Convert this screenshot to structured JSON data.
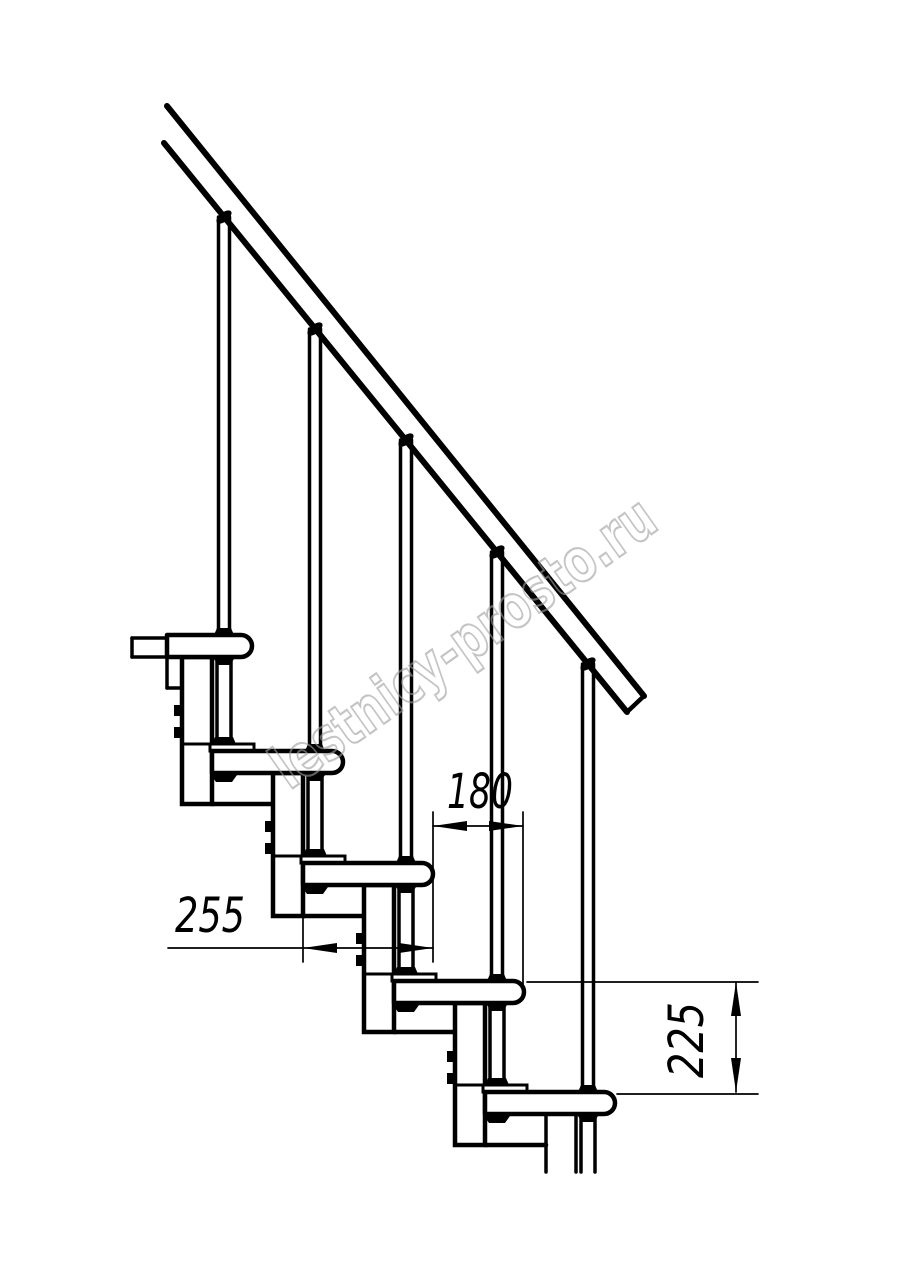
{
  "meta": {
    "title": "Modular staircase side-view technical drawing",
    "watermark_text": "lestnicy-prosto.ru"
  },
  "dimensions_mm": {
    "tread_depth_label": "255",
    "step_run_label": "180",
    "step_rise_label": "225"
  },
  "drawing": {
    "canvas": {
      "w": 914,
      "h": 1280,
      "bg": "#ffffff",
      "ink": "#000000"
    },
    "rail": {
      "top_line": [
        167,
        106,
        644,
        696
      ],
      "bottom_line": [
        164,
        143,
        627,
        712
      ],
      "end_cap": [
        644,
        696,
        627,
        712
      ],
      "stroke": 6
    },
    "tread": {
      "h": 22,
      "r": 11,
      "stroke": 4.5
    },
    "treads": [
      {
        "x": 167,
        "y": 635,
        "len": 85
      },
      {
        "x": 212,
        "y": 751,
        "len": 131
      },
      {
        "x": 303,
        "y": 863,
        "len": 130
      },
      {
        "x": 394,
        "y": 981,
        "len": 130
      },
      {
        "x": 485,
        "y": 1092,
        "len": 130
      }
    ],
    "axes": [
      224,
      315,
      406,
      497,
      588
    ],
    "baluster_tops": [
      217,
      329,
      440,
      552,
      664
    ],
    "columns": [
      {
        "x": 182,
        "top": 657,
        "bottom": 804,
        "divider": 744
      },
      {
        "x": 273,
        "top": 773,
        "bottom": 916,
        "divider": 856
      },
      {
        "x": 364,
        "top": 885,
        "bottom": 1032,
        "divider": 974
      },
      {
        "x": 455,
        "top": 1003,
        "bottom": 1145,
        "divider": 1085
      }
    ],
    "column_w": 30,
    "bolt_offsets": [
      48,
      70
    ],
    "rod_modules": [
      {
        "a": 224,
        "y1": 657,
        "y2": 751,
        "cut": false
      },
      {
        "a": 315,
        "y1": 773,
        "y2": 863,
        "cut": false
      },
      {
        "a": 406,
        "y1": 885,
        "y2": 981,
        "cut": false
      },
      {
        "a": 497,
        "y1": 1003,
        "y2": 1092,
        "cut": false
      },
      {
        "a": 588,
        "y1": 1114,
        "y2": 1172,
        "cut": true
      }
    ],
    "extra_lines": [
      [
        132,
        638,
        167,
        638
      ],
      [
        132,
        657,
        167,
        657
      ],
      [
        132,
        638,
        132,
        657
      ],
      [
        167,
        657,
        167,
        688
      ],
      [
        167,
        688,
        182,
        688
      ],
      [
        546,
        1114,
        546,
        1172
      ],
      [
        576,
        1114,
        576,
        1172
      ]
    ],
    "dims": [
      {
        "label_key": "step_run_label",
        "text": {
          "x": 447,
          "y": 808,
          "len": 66,
          "rot": 0
        },
        "lines": [
          [
            433,
            826,
            523,
            826
          ],
          [
            433,
            812,
            433,
            962
          ],
          [
            523,
            812,
            523,
            984
          ]
        ],
        "arrows": [
          {
            "x": 433,
            "y": 826,
            "dir": "l"
          },
          {
            "x": 523,
            "y": 826,
            "dir": "r"
          }
        ]
      },
      {
        "label_key": "tread_depth_label",
        "text": {
          "x": 175,
          "y": 932,
          "len": 70,
          "rot": 0
        },
        "lines": [
          [
            168,
            948,
            433,
            948
          ],
          [
            303,
            916,
            303,
            962
          ]
        ],
        "arrows": [
          {
            "x": 303,
            "y": 948,
            "dir": "l"
          },
          {
            "x": 433,
            "y": 948,
            "dir": "r"
          }
        ]
      },
      {
        "label_key": "step_rise_label",
        "text": {
          "x": 703,
          "y": 1078,
          "len": 76,
          "rot": -90
        },
        "lines": [
          [
            736,
            982,
            736,
            1092
          ],
          [
            527,
            982,
            758,
            982
          ],
          [
            617,
            1094,
            758,
            1094
          ]
        ],
        "arrows": [
          {
            "x": 736,
            "y": 982,
            "dir": "u"
          },
          {
            "x": 736,
            "y": 1092,
            "dir": "d"
          }
        ]
      }
    ],
    "dim_font_size": 48,
    "dim_stroke": 1.7,
    "watermark": {
      "cx": 463,
      "cy": 642,
      "angle": -35.3,
      "font_size": 60,
      "length": 455,
      "color": "#9e9e9e",
      "opacity": 0.6,
      "stroke_w": 2.2
    }
  }
}
